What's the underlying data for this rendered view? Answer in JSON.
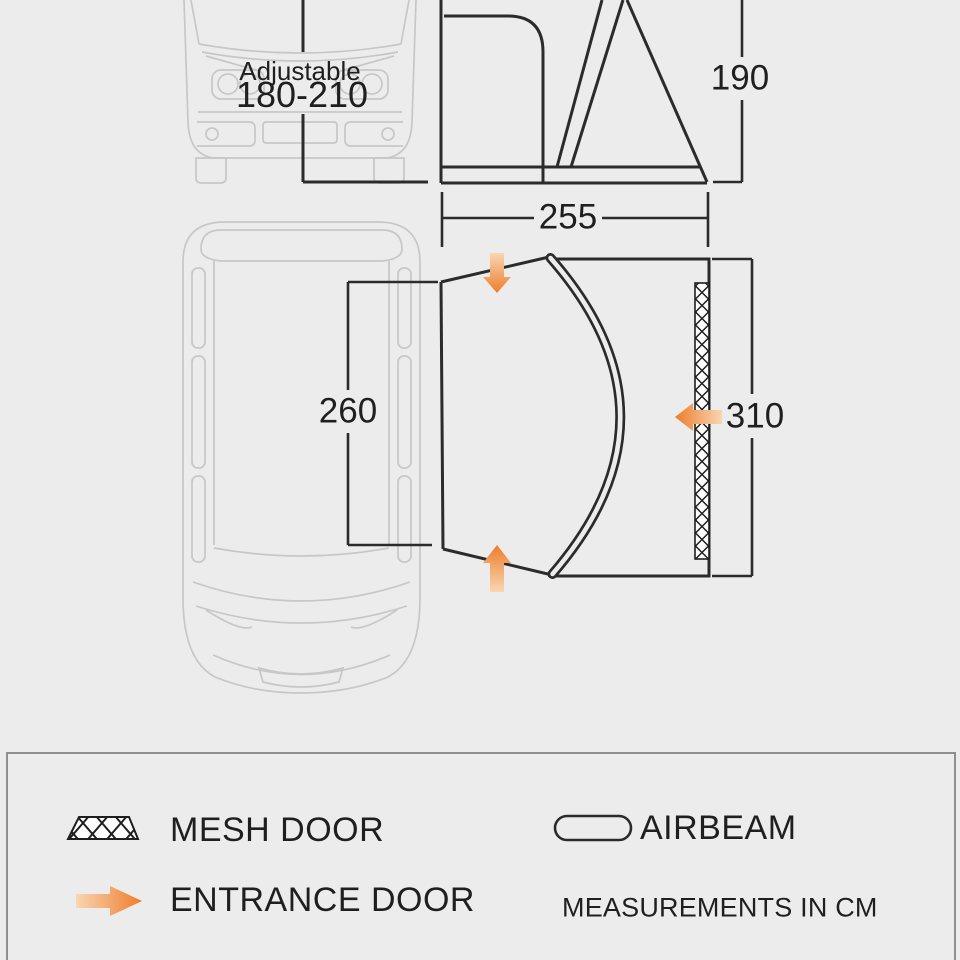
{
  "colors": {
    "background": "#ececec",
    "diagram_line": "#2b2b2b",
    "van_outline": "#c7c7c7",
    "accent_orange": "#ee7d2b",
    "accent_orange_pale": "#f7d0a8",
    "legend_border": "#8f8f8f",
    "text": "#1f1f1f"
  },
  "front_view": {
    "adjustable_label": "Adjustable",
    "adjustable_range": "180-210"
  },
  "side_view": {
    "height_cm": "190"
  },
  "top_view": {
    "tunnel_width_cm": "255",
    "van_side_length_cm": "260",
    "awning_side_length_cm": "310"
  },
  "legend": {
    "mesh_door_label": "MESH DOOR",
    "airbeam_label": "AIRBEAM",
    "entrance_door_label": "ENTRANCE DOOR",
    "measurements_note": "MEASUREMENTS IN CM"
  }
}
